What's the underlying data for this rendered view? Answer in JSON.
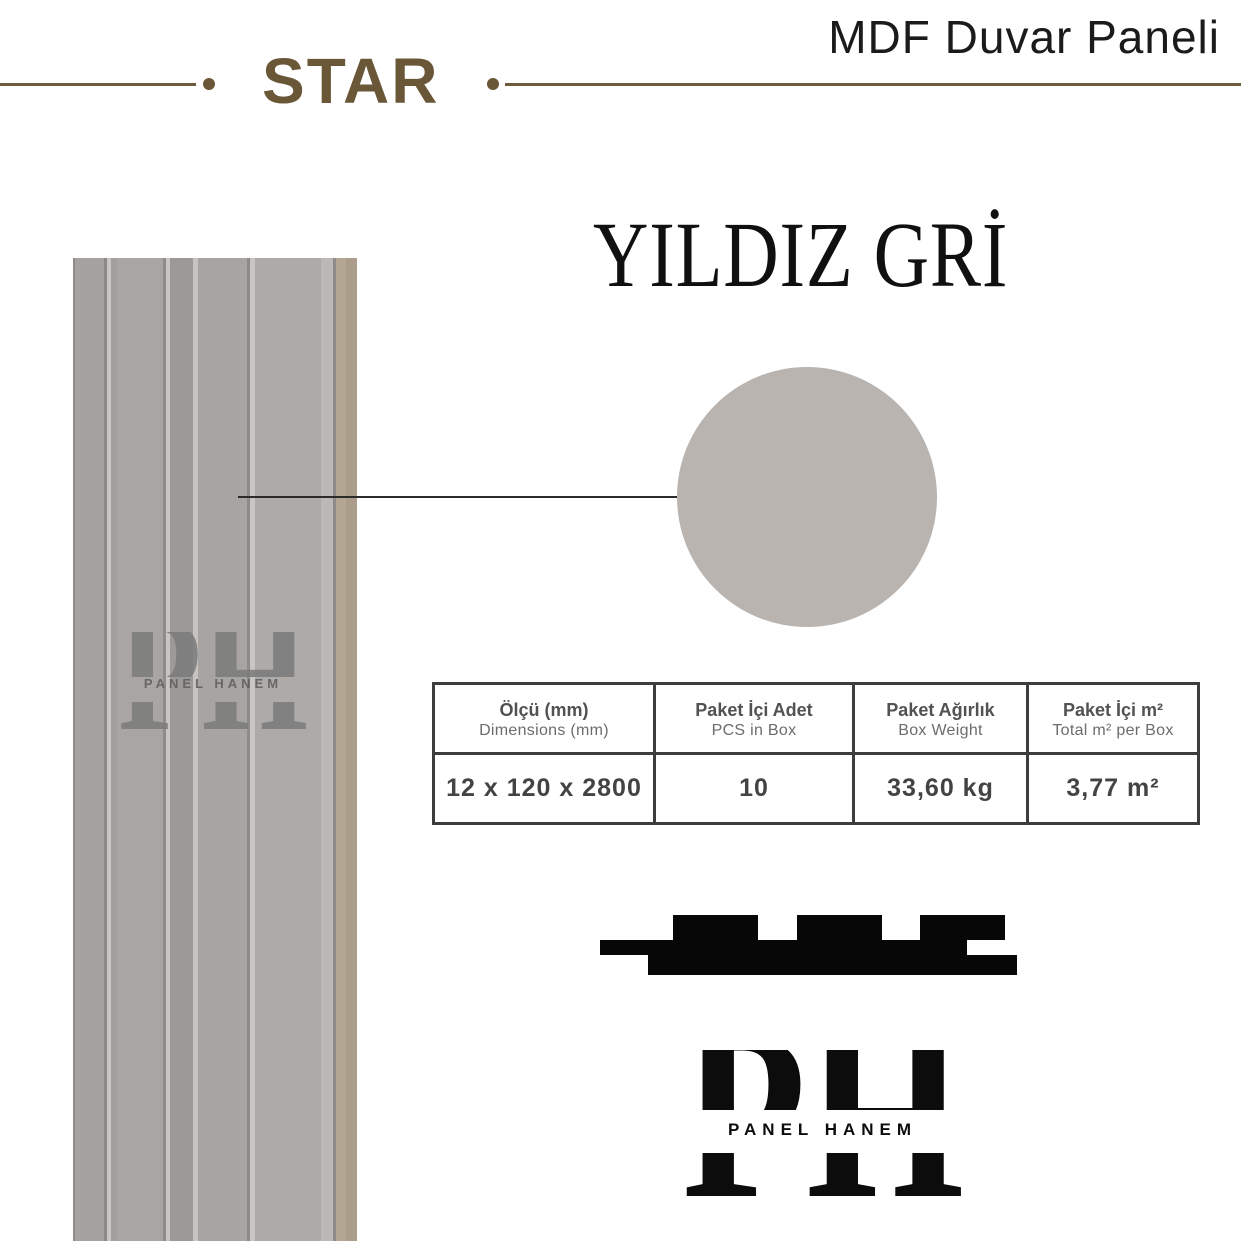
{
  "header": {
    "series_name": "STAR",
    "product_type": "MDF Duvar Paneli"
  },
  "product": {
    "color_name": "YILDIZ GRİ",
    "swatch_color": "#b9b4b0"
  },
  "specs_table": {
    "columns": [
      {
        "title": "Ölçü (mm)",
        "subtitle": "Dimensions (mm)"
      },
      {
        "title": "Paket İçi Adet",
        "subtitle": "PCS in Box"
      },
      {
        "title": "Paket Ağırlık",
        "subtitle": "Box Weight"
      },
      {
        "title": "Paket İçi m²",
        "subtitle": "Total m² per Box"
      }
    ],
    "row": [
      "12 x 120 x 2800",
      "10",
      "33,60 kg",
      "3,77 m²"
    ]
  },
  "watermark": {
    "monogram": "PH",
    "name": "PANEL HANEM"
  },
  "brand_logo": {
    "monogram": "PH",
    "name": "PANEL HANEM"
  },
  "colors": {
    "accent_brown": "#6a5738",
    "table_border": "#3d3d3d",
    "swatch_gray": "#b9b4b0",
    "panel_gray": "#a9a5a3",
    "mdf_edge_tan": "#b3a693"
  }
}
